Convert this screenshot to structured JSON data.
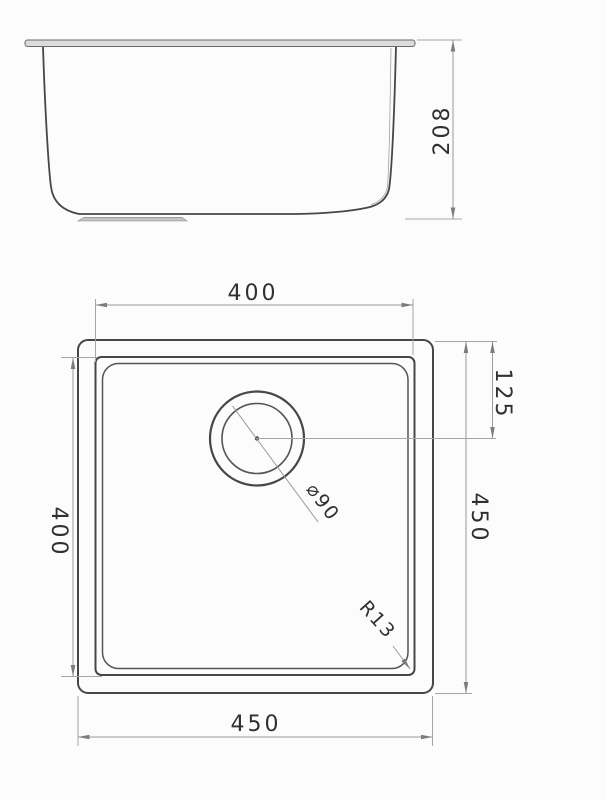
{
  "title": "Square undermount sink technical drawing",
  "views": {
    "side": {
      "name": "side-section-view"
    },
    "plan": {
      "name": "plan-view"
    }
  },
  "labels": {
    "overall_height": "208",
    "bowl_width_top": "400",
    "bowl_width_left": "400",
    "overall_size_right": "450",
    "drain_offset": "125",
    "overall_size_bottom": "450",
    "drain_diameter": "⌀90",
    "corner_radius": "R13"
  },
  "colors": {
    "background": "#fcfcfc",
    "object_line": "#474747",
    "dimension_line": "#9a9a9a",
    "text": "#303030",
    "rim_fill": "#dcdcdc",
    "drain_strip_fill": "#c2c2c2"
  }
}
